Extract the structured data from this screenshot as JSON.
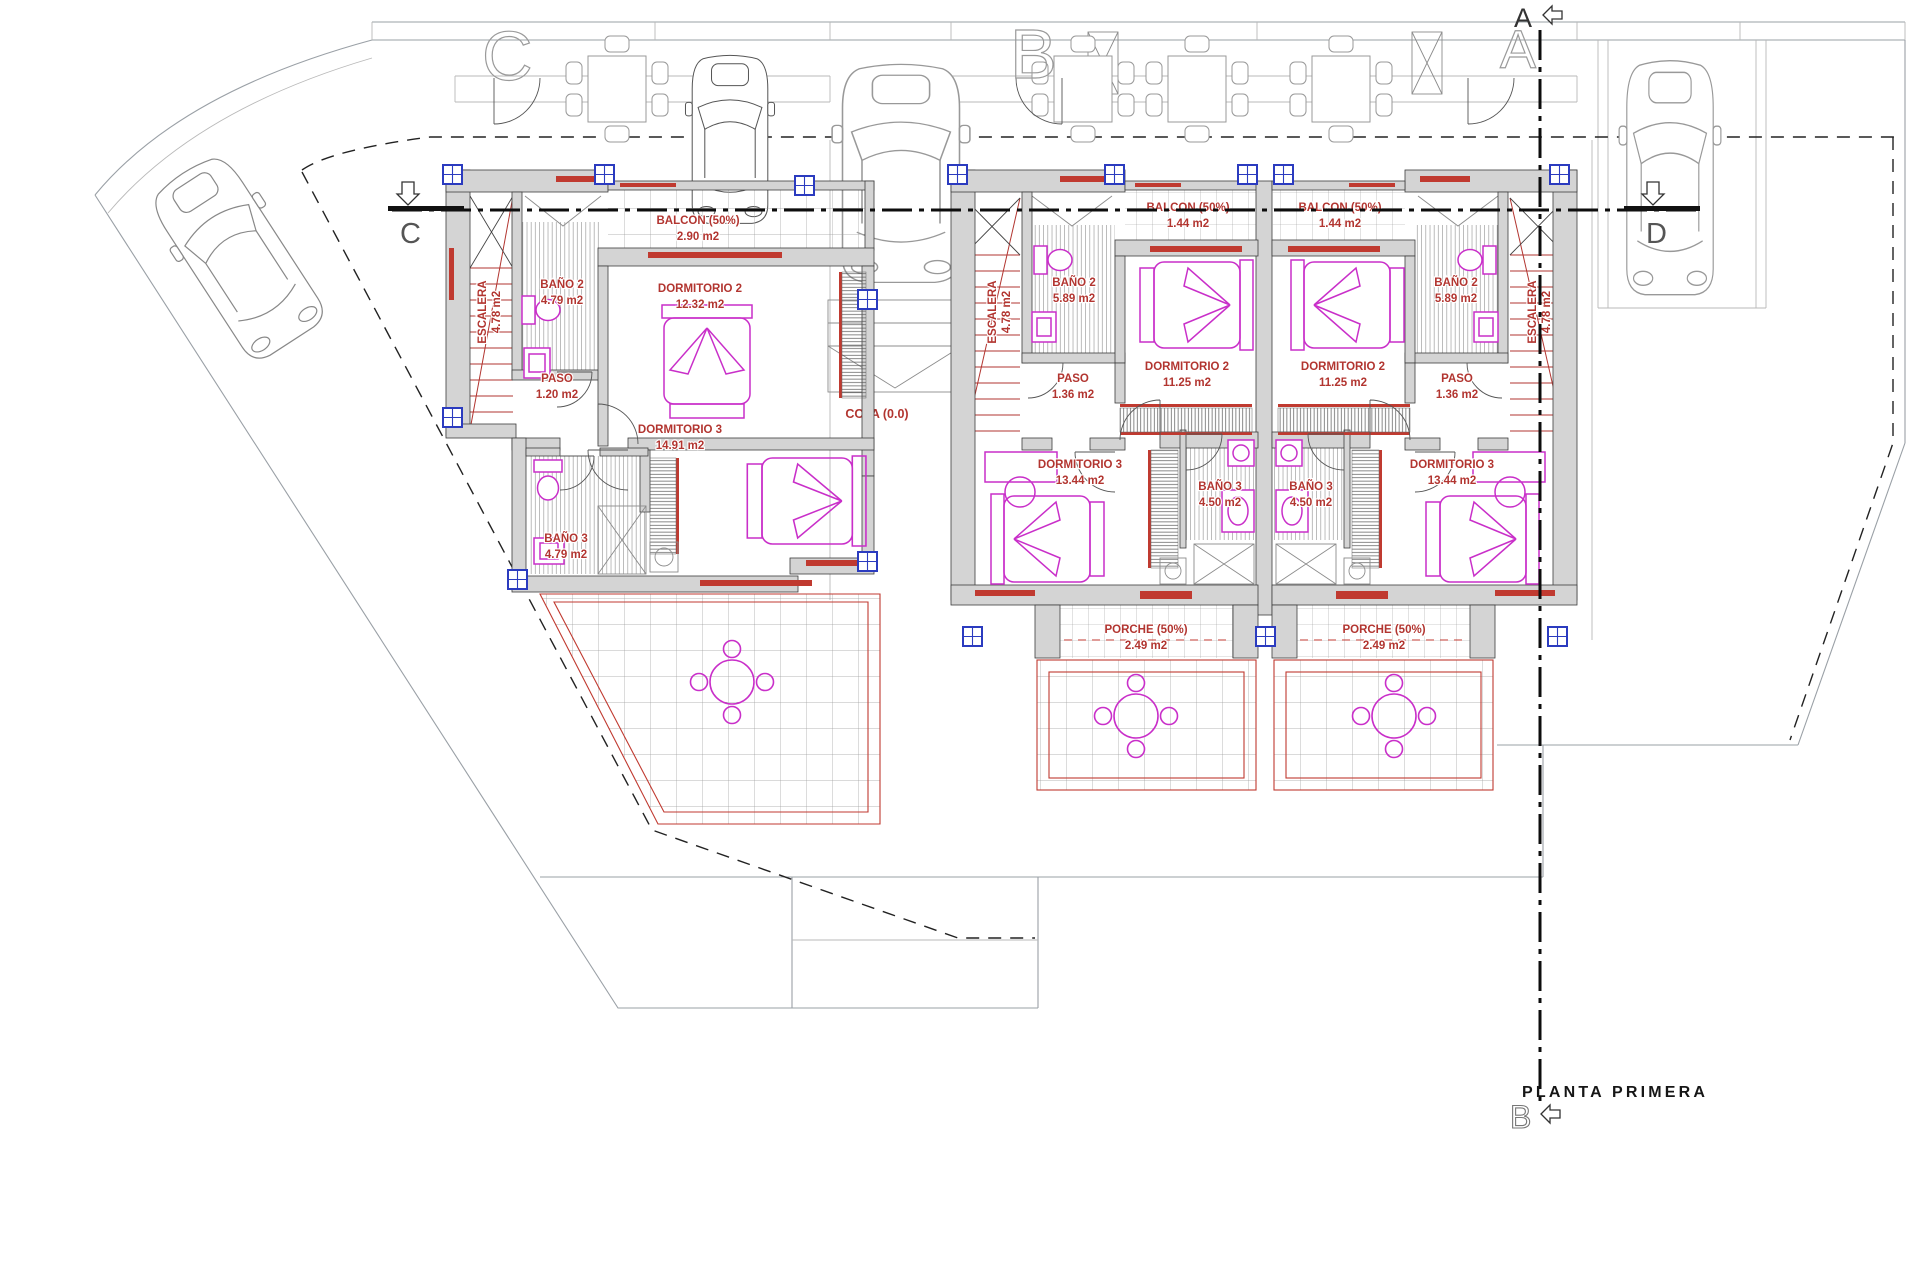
{
  "plan": {
    "title": "PLANTA PRIMERA",
    "cota": "COTA (0.0)"
  },
  "sections": {
    "a": "A",
    "b": "B",
    "c": "C",
    "d": "D"
  },
  "unit_letters": {
    "left": "C",
    "middle": "B",
    "right": "A"
  },
  "units": {
    "left": {
      "escalera_name": "ESCALERA",
      "escalera_area": "4.78 m2",
      "balcon_name": "BALCON (50%)",
      "balcon_area": "2.90 m2",
      "bano2_name": "BAÑO 2",
      "bano2_area": "4.79 m2",
      "dorm2_name": "DORMITORIO 2",
      "dorm2_area": "12.32 m2",
      "paso_name": "PASO",
      "paso_area": "1.20 m2",
      "dorm3_name": "DORMITORIO 3",
      "dorm3_area": "14.91 m2",
      "bano3_name": "BAÑO 3",
      "bano3_area": "4.79 m2"
    },
    "middle": {
      "escalera_name": "ESCALERA",
      "escalera_area": "4.78 m2",
      "balcon_name": "BALCON (50%)",
      "balcon_area": "1.44 m2",
      "bano2_name": "BAÑO 2",
      "bano2_area": "5.89 m2",
      "dorm2_name": "DORMITORIO 2",
      "dorm2_area": "11.25 m2",
      "paso_name": "PASO",
      "paso_area": "1.36 m2",
      "dorm3_name": "DORMITORIO 3",
      "dorm3_area": "13.44 m2",
      "bano3_name": "BAÑO 3",
      "bano3_area": "4.50 m2",
      "porche_name": "PORCHE (50%)",
      "porche_area": "2.49 m2"
    },
    "right": {
      "escalera_name": "ESCALERA",
      "escalera_area": "4.78 m2",
      "balcon_name": "BALCON (50%)",
      "balcon_area": "1.44 m2",
      "bano2_name": "BAÑO 2",
      "bano2_area": "5.89 m2",
      "dorm2_name": "DORMITORIO 2",
      "dorm2_area": "11.25 m2",
      "paso_name": "PASO",
      "paso_area": "1.36 m2",
      "dorm3_name": "DORMITORIO 3",
      "dorm3_area": "13.44 m2",
      "bano3_name": "BAÑO 3",
      "bano3_area": "4.50 m2",
      "porche_name": "PORCHE (50%)",
      "porche_area": "2.49 m2"
    }
  }
}
